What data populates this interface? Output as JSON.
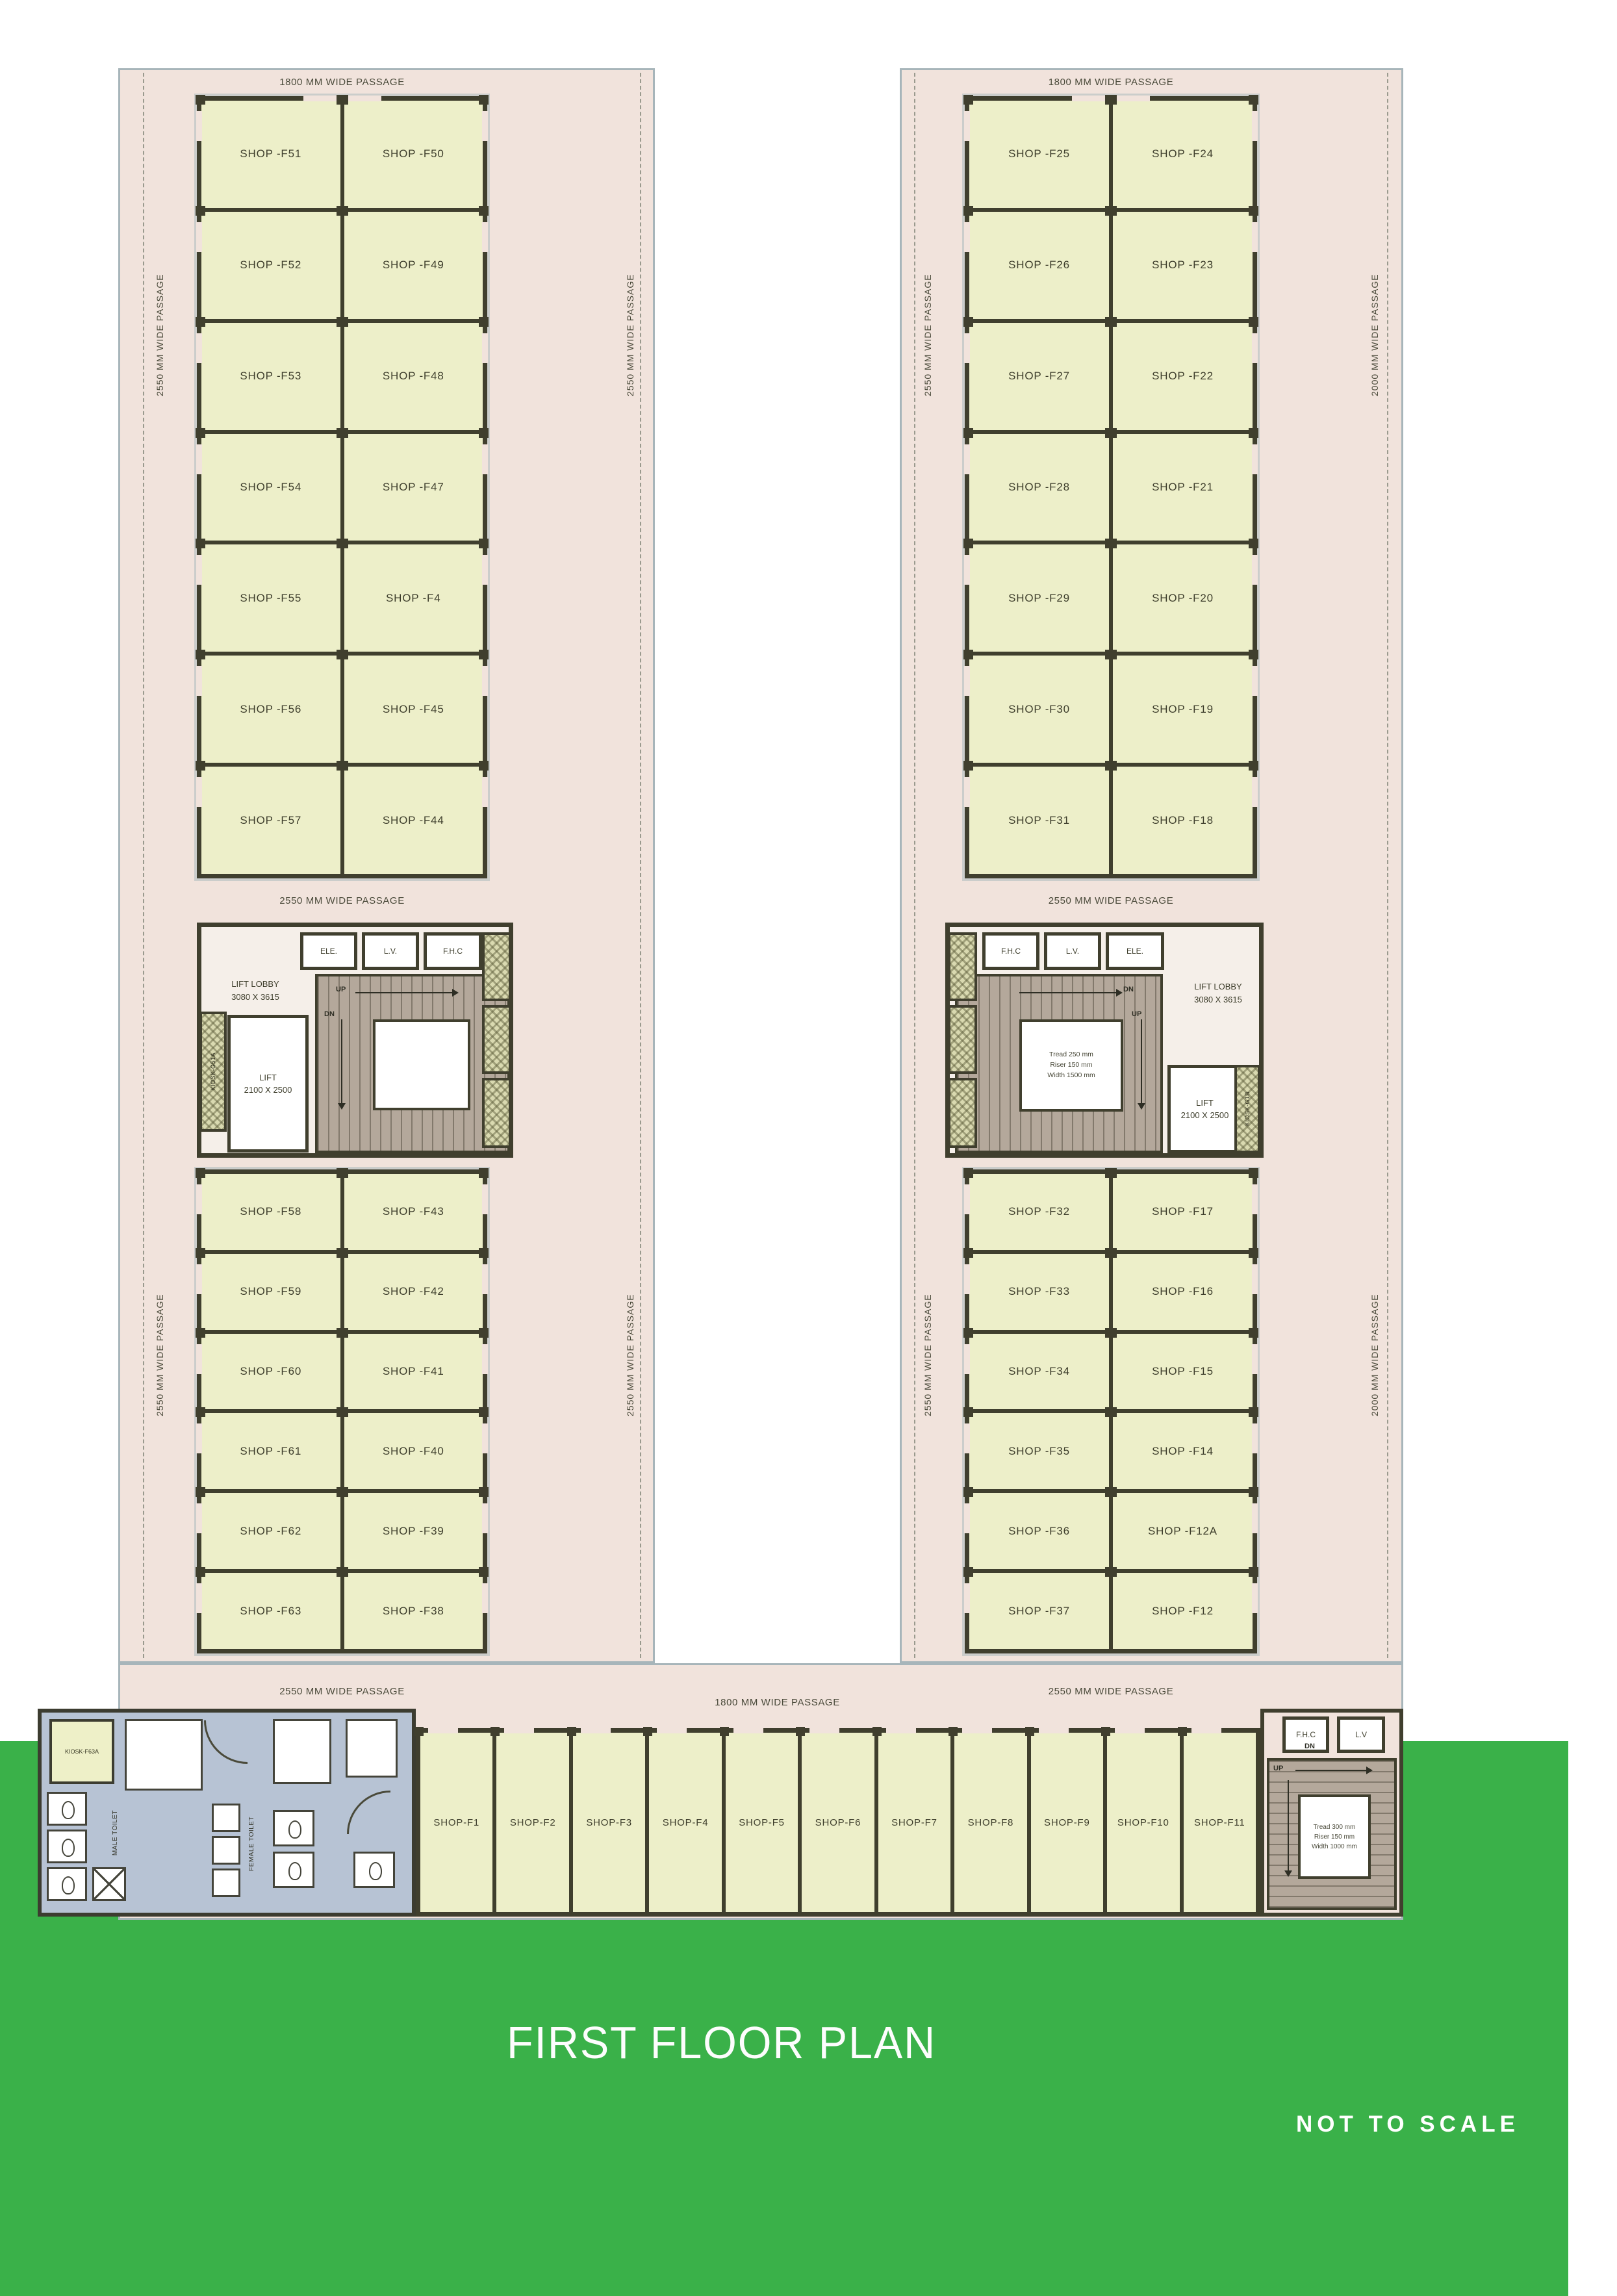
{
  "title": "FIRST FLOOR PLAN",
  "scale_note": "NOT TO SCALE",
  "colors": {
    "green_band": "#3ab149",
    "floor_pink": "#f1e3dc",
    "shop_fill": "#edefc9",
    "wall": "#403f2e",
    "stair_tan": "#b4a89b",
    "toilet_blue": "#b7c3d4"
  },
  "passages": {
    "left_top": "1800 MM WIDE PASSAGE",
    "right_top": "1800 MM WIDE PASSAGE",
    "left_mid": "2550 MM WIDE PASSAGE",
    "right_mid": "2550 MM WIDE PASSAGE",
    "bottom_left": "2550 MM WIDE PASSAGE",
    "bottom_mid": "1800 MM WIDE PASSAGE",
    "bottom_right": "2550 MM WIDE PASSAGE",
    "left_outer_upper": "2550 MM WIDE PASSAGE",
    "left_outer_lower": "2550 MM WIDE PASSAGE",
    "left_inner_upper": "2550 MM WIDE PASSAGE",
    "left_inner_lower": "2550 MM WIDE PASSAGE",
    "right_inner_upper": "2550 MM WIDE PASSAGE",
    "right_inner_lower": "2550 MM WIDE PASSAGE",
    "right_outer_upper": "2000 MM WIDE PASSAGE",
    "right_outer_lower": "2000 MM WIDE PASSAGE"
  },
  "left_wing": {
    "top_rows": [
      [
        "SHOP -F51",
        "SHOP -F50"
      ],
      [
        "SHOP -F52",
        "SHOP -F49"
      ],
      [
        "SHOP -F53",
        "SHOP -F48"
      ],
      [
        "SHOP -F54",
        "SHOP -F47"
      ],
      [
        "SHOP -F55",
        "SHOP -F4"
      ],
      [
        "SHOP -F56",
        "SHOP -F45"
      ],
      [
        "SHOP -F57",
        "SHOP -F44"
      ]
    ],
    "lower_rows": [
      [
        "SHOP -F58",
        "SHOP -F43"
      ],
      [
        "SHOP -F59",
        "SHOP -F42"
      ],
      [
        "SHOP -F60",
        "SHOP -F41"
      ],
      [
        "SHOP -F61",
        "SHOP -F40"
      ],
      [
        "SHOP -F62",
        "SHOP -F39"
      ],
      [
        "SHOP -F63",
        "SHOP -F38"
      ]
    ],
    "lobby": {
      "lift_lobby": "LIFT LOBBY",
      "lift_lobby_dim": "3080 X 3615",
      "lift": "LIFT",
      "lift_dim": "2100 X 2500",
      "room_1": "ELE.",
      "room_2": "L.V.",
      "room_3": "F.H.C",
      "up": "UP",
      "dn": "DN",
      "kiosk_side": "KIOSK-G51A"
    }
  },
  "right_wing": {
    "top_rows": [
      [
        "SHOP -F25",
        "SHOP -F24"
      ],
      [
        "SHOP -F26",
        "SHOP -F23"
      ],
      [
        "SHOP -F27",
        "SHOP -F22"
      ],
      [
        "SHOP -F28",
        "SHOP -F21"
      ],
      [
        "SHOP -F29",
        "SHOP -F20"
      ],
      [
        "SHOP -F30",
        "SHOP -F19"
      ],
      [
        "SHOP -F31",
        "SHOP -F18"
      ]
    ],
    "lower_rows": [
      [
        "SHOP -F32",
        "SHOP -F17"
      ],
      [
        "SHOP -F33",
        "SHOP -F16"
      ],
      [
        "SHOP -F34",
        "SHOP -F15"
      ],
      [
        "SHOP -F35",
        "SHOP -F14"
      ],
      [
        "SHOP -F36",
        "SHOP -F12A"
      ],
      [
        "SHOP -F37",
        "SHOP -F12"
      ]
    ],
    "lobby": {
      "lift_lobby": "LIFT LOBBY",
      "lift_lobby_dim": "3080 X 3615",
      "lift": "LIFT",
      "lift_dim": "2100 X 2500",
      "room_1": "F.H.C",
      "room_2": "L.V.",
      "room_3": "ELE.",
      "up": "UP",
      "dn": "DN",
      "kiosk_side": "KIOSK-G1B",
      "stair_note_1": "Tread 250 mm",
      "stair_note_2": "Riser 150 mm",
      "stair_note_3": "Width 1500 mm"
    }
  },
  "ground": {
    "shops": [
      "SHOP-F1",
      "SHOP-F2",
      "SHOP-F3",
      "SHOP-F4",
      "SHOP-F5",
      "SHOP-F6",
      "SHOP-F7",
      "SHOP-F8",
      "SHOP-F9",
      "SHOP-F10",
      "SHOP-F11"
    ],
    "toilet": {
      "kiosk": "KIOSK-F63A",
      "male": "MALE TOILET",
      "female": "FEMALE TOILET"
    },
    "stairs": {
      "room_1": "F.H.C",
      "room_2": "L.V",
      "up": "UP",
      "dn": "DN",
      "note_1": "Tread 300 mm",
      "note_2": "Riser 150 mm",
      "note_3": "Width 1000 mm"
    }
  }
}
